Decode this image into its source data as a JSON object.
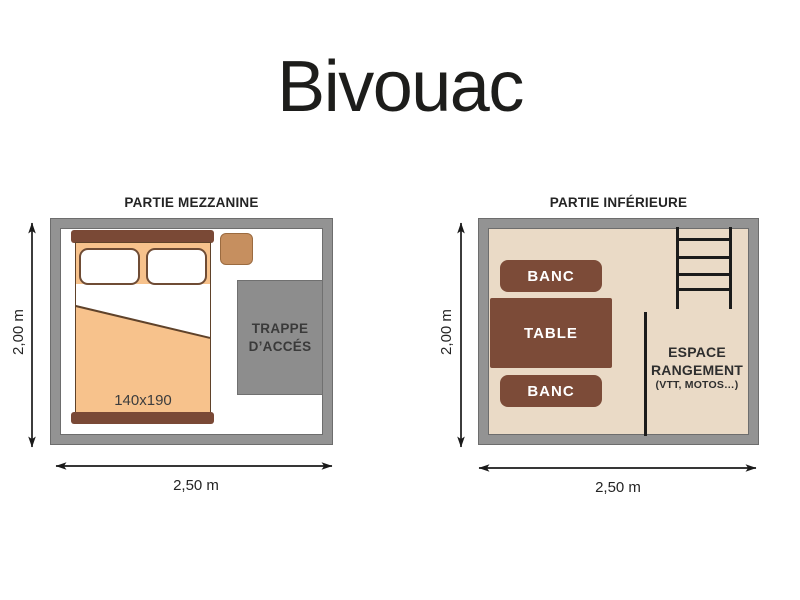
{
  "title": "Bivouac",
  "mezzanine": {
    "title": "PARTIE MEZZANINE",
    "bed_size_label": "140x190",
    "hatch_label_line1": "TRAPPE",
    "hatch_label_line2": "D’ACCÉS",
    "height_label": "2,00 m",
    "width_label": "2,50 m"
  },
  "inferieure": {
    "title": "PARTIE INFÉRIEURE",
    "bench_top_label": "BANC",
    "table_label": "TABLE",
    "bench_bottom_label": "BANC",
    "storage_line1": "ESPACE",
    "storage_line2": "RANGEMENT",
    "storage_line3": "(VTT, MOTOS…)",
    "height_label": "2,00 m",
    "width_label": "2,50 m"
  },
  "colors": {
    "wall_gray": "#939393",
    "wall_outline": "#6d6d6d",
    "hatch_gray": "#8d8d8d",
    "bed_orange": "#f7c28c",
    "wood_brown": "#7c4b38",
    "stool_tan": "#c68f5f",
    "floor_beige": "#eadac6",
    "line_black": "#1b1b1b"
  }
}
